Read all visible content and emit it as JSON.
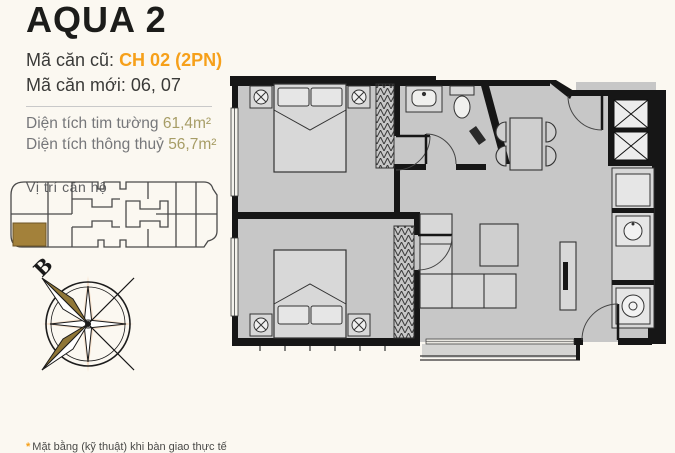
{
  "colors": {
    "background": "#fbf8f1",
    "title_text": "#1c1c1a",
    "body_text": "#3a3a38",
    "accent_orange": "#f6a01a",
    "muted_gray": "#76777a",
    "area_value_olive": "#a79d66",
    "unit_highlight_gold": "#a3813a",
    "plan_wall_black": "#161616",
    "plan_floor_gray": "#c7c7c7",
    "compass_gold": "#8f7637"
  },
  "header": {
    "title": "AQUA 2",
    "old_code_label": "Mã căn cũ:",
    "old_code_value": "CH 02 (2PN)",
    "new_code_label": "Mã căn mới:",
    "new_code_value": "06, 07",
    "area_rows": [
      {
        "label": "Diện tích tim tường",
        "value": "61,4m²"
      },
      {
        "label": "Diện tích thông thuỷ",
        "value": "56,7m²"
      }
    ]
  },
  "location": {
    "label": "Vị trí căn hộ",
    "highlighted_unit": "bottom-left unit"
  },
  "compass": {
    "north_label": "B"
  },
  "floor_plan": {
    "elements": [
      "bedroom-1-bed",
      "bedroom-1-wardrobe",
      "bedroom-2-bed",
      "bedroom-2-wardrobe",
      "bathroom-sink",
      "bathroom-toilet",
      "dining-table-4-chairs",
      "kitchen-stove",
      "kitchen-counter",
      "kitchen-sink",
      "washing-machine",
      "living-sofa",
      "coffee-table",
      "tv-cabinet",
      "balcony-railing",
      "entry-door",
      "bedroom-doors",
      "windows"
    ]
  },
  "footnote": {
    "marker": "*",
    "text": "Mặt bằng (kỹ thuật) khi bàn giao thực tế"
  }
}
